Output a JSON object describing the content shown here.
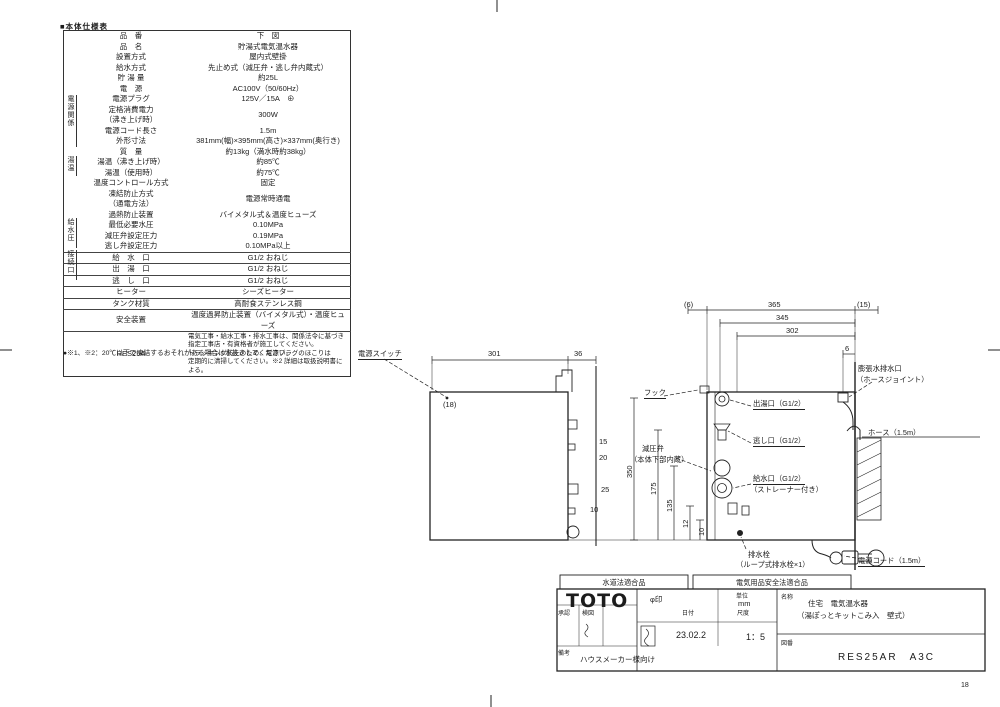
{
  "sheet": {
    "page_number": "18"
  },
  "spec_table": {
    "title": "■本体仕様表",
    "groups": [
      {
        "label": "電源関係"
      },
      {
        "label": "湯温"
      },
      {
        "label": "給水圧"
      },
      {
        "label": "接続口"
      }
    ],
    "rows": [
      {
        "l": [
          "品　番"
        ],
        "v": [
          "下　図"
        ]
      },
      {
        "l": [
          "品　名"
        ],
        "v": [
          "貯湯式電気温水器"
        ]
      },
      {
        "l": [
          "設置方式"
        ],
        "v": [
          "屋内式壁掛"
        ]
      },
      {
        "l": [
          "給水方式"
        ],
        "v": [
          "先止め式（減圧弁・逃し弁内蔵式）"
        ]
      },
      {
        "l": [
          "貯 湯 量"
        ],
        "v": [
          "約25L"
        ]
      },
      {
        "l": [
          "電　源"
        ],
        "v": [
          "AC100V（50/60Hz）"
        ]
      },
      {
        "l": [
          "電源プラグ"
        ],
        "v": [
          "125V／15A　⊕"
        ]
      },
      {
        "l": [
          "定格消費電力",
          "（沸き上げ時）"
        ],
        "v": [
          "300W"
        ]
      },
      {
        "l": [
          "電源コード長さ"
        ],
        "v": [
          "1.5m"
        ]
      },
      {
        "l": [
          "外形寸法"
        ],
        "v": [
          "381mm(幅)×395mm(高さ)×337mm(奥行き)"
        ]
      },
      {
        "l": [
          "質　量"
        ],
        "v": [
          "約13kg（満水時約38kg）"
        ]
      },
      {
        "l": [
          "湯温（沸き上げ時）"
        ],
        "v": [
          "約85℃"
        ]
      },
      {
        "l": [
          "湯温（使用時）"
        ],
        "v": [
          "約75℃"
        ]
      },
      {
        "l": [
          "温度コントロール方式"
        ],
        "v": [
          "固定"
        ]
      },
      {
        "l": [
          "凍結防止方式",
          "（通電方法）"
        ],
        "v": [
          "電源常時通電"
        ]
      },
      {
        "l": [
          "過熱防止装置"
        ],
        "v": [
          "バイメタル式＆温度ヒューズ"
        ]
      },
      {
        "l": [
          "最低必要水圧"
        ],
        "v": [
          "0.10MPa"
        ]
      },
      {
        "l": [
          "減圧弁設定圧力"
        ],
        "v": [
          "0.19MPa"
        ]
      },
      {
        "l": [
          "逃し弁設定圧力"
        ],
        "v": [
          "0.10MPa以上"
        ]
      },
      {
        "l": [
          "給　水　口"
        ],
        "v": [
          "G1/2 おねじ"
        ],
        "cls": "bordered"
      },
      {
        "l": [
          "出　湯　口"
        ],
        "v": [
          "G1/2 おねじ"
        ],
        "cls": "bordered"
      },
      {
        "l": [
          "逃　し　口"
        ],
        "v": [
          "G1/2 おねじ"
        ],
        "cls": "bordered"
      },
      {
        "l": [
          "ヒーター"
        ],
        "v": [
          "シーズヒーター"
        ],
        "cls": "bordered"
      },
      {
        "l": [
          "タンク材質"
        ],
        "v": [
          "高耐食ステンレス鋼"
        ],
        "cls": "bordered"
      },
      {
        "l": [
          "安全装置"
        ],
        "v": [
          "温度過昇防止装置（バイメタル式）・温度ヒューズ"
        ],
        "cls": "bordered"
      },
      {
        "l": [
          "RES25A"
        ],
        "v": [
          "電気工事・給水工事・排水工事は、関係法令に基づき",
          "指定工事店・有資格者が施工してください。",
          "トラッキング防止のため、電源プラグのほこりは",
          "定期的に清掃してください。※2 詳細は取扱説明書による。"
        ],
        "cls": "bordered note"
      }
    ],
    "footnote": "●※1、※2：20℃以下で凍結するおそれがある場合は水抜きしてください。"
  },
  "drawing": {
    "labels": {
      "power_switch": "電源スイッチ",
      "hook": "フック",
      "outlet": "出湯口（G1/2）",
      "relief": "逃し口（G1/2）",
      "inlet1": "給水口（G1/2）",
      "inlet2": "（ストレーナー付き）",
      "valve1": "減圧弁",
      "valve2": "（本体下部内蔵）",
      "expansion1": "膨張水排水口",
      "expansion2": "（ホースジョイント）",
      "drain1": "排水栓",
      "drain2": "（ループ式排水栓×1）",
      "cord": "電源コード（1.5m）",
      "hose": "ホース（1.5m）"
    },
    "dims": {
      "side_width": "301",
      "bracket": "36",
      "switch_offset": "(18)",
      "s15": "15",
      "s20": "20",
      "s25": "25",
      "s10": "10",
      "m350": "350",
      "m175": "175",
      "m135": "135",
      "m12": "12",
      "m10": "10",
      "f6l": "(6)",
      "f365": "365",
      "f345": "345",
      "f302": "302",
      "f15r": "(15)",
      "f6": "6"
    }
  },
  "title_block": {
    "tab1": "水道法適合品",
    "tab2": "電気用品安全法適合品",
    "logo": "TOTO",
    "phi": "φ印",
    "unit_label": "単位",
    "unit_value": "mm",
    "date_label": "日付",
    "date_value": "23.02.2",
    "scale_label": "尺度",
    "scale_value": "1：5",
    "name_label": "名称",
    "name_line1": "住宅　電気温水器",
    "name_line2": "（湯ぽっとキットこみ入　壁式）",
    "zuban_label": "図番",
    "zuban_value": "RES25AR　A3C",
    "approve_label": "承認",
    "check_label": "検図",
    "note_label": "備考",
    "audience": "ハウスメーカー様向け"
  }
}
